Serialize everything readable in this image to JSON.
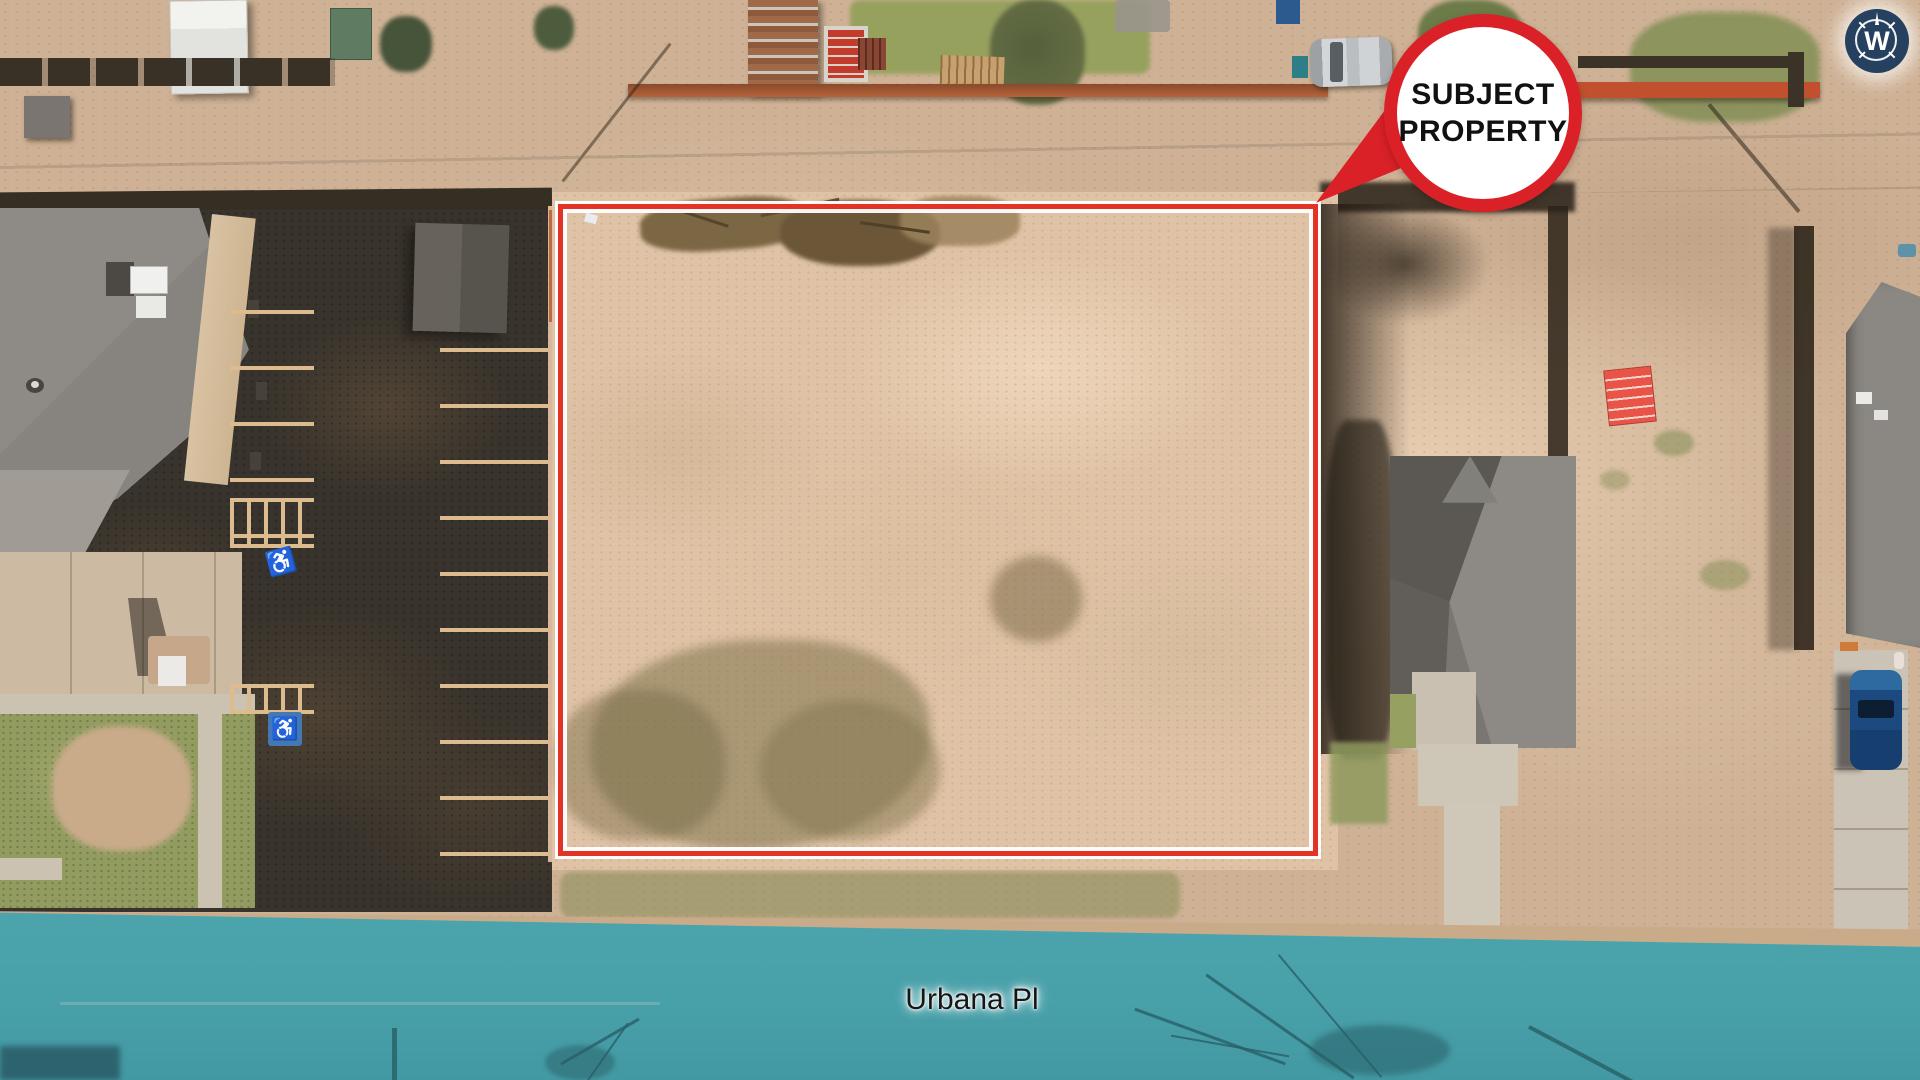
{
  "annotations": {
    "subject_callout": {
      "line1": "SUBJECT",
      "line2": "PROPERTY"
    },
    "street_label": "Urbana Pl",
    "compass": {
      "letter": "W"
    }
  },
  "icons": {
    "handicap_glyph": "♿",
    "compass_icon": "compass-rose-with-W",
    "callout_icon": "balloon-pointer"
  },
  "colors": {
    "boundary_red": "#e23426",
    "callout_red": "#da2127",
    "callout_text": "#111111",
    "street_teal": "#4ca4ad",
    "street_teal_dark": "#4399a3",
    "street_label_color": "#161616",
    "compass_navy": "#25415f",
    "asphalt": "#38332c",
    "dirt_base": "#cfb296",
    "dirt_light": "#e0c3a6",
    "grass": "#929c60",
    "stripe_tan": "#dcbc8e",
    "roof_gray": "#8e8a86",
    "concrete": "#cbc2b1",
    "orange_fence": "#b5643a",
    "car_blue": "#1c4a80"
  }
}
